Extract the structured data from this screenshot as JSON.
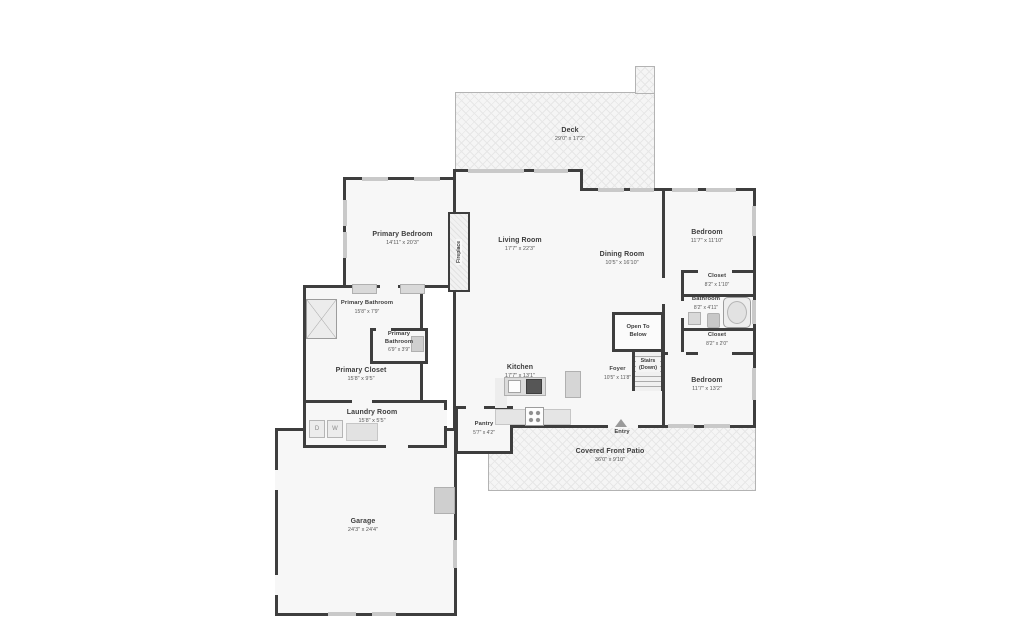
{
  "colors": {
    "wall": "#3e3e3e",
    "floor": "#f7f7f7",
    "window": "#c9c9c9",
    "hatch": "#e7e7e7",
    "text": "#3d3d3d"
  },
  "rooms": {
    "deck": {
      "name": "Deck",
      "dims": "29'0\" x 17'2\""
    },
    "primary_bedroom": {
      "name": "Primary Bedroom",
      "dims": "14'11\" x 20'3\""
    },
    "living_room": {
      "name": "Living Room",
      "dims": "17'7\" x 22'3\""
    },
    "dining_room": {
      "name": "Dining Room",
      "dims": "10'5\" x 16'10\""
    },
    "bedroom_upper": {
      "name": "Bedroom",
      "dims": "11'7\" x 11'10\""
    },
    "closet_upper": {
      "name": "Closet",
      "dims": "8'2\" x 1'10\""
    },
    "bathroom": {
      "name": "Bathroom",
      "dims": "8'2\" x 4'11\""
    },
    "closet_lower": {
      "name": "Closet",
      "dims": "8'2\" x 2'0\""
    },
    "bedroom_lower": {
      "name": "Bedroom",
      "dims": "11'7\" x 13'2\""
    },
    "foyer": {
      "name": "Foyer",
      "dims": "10'5\" x 11'8\""
    },
    "kitchen": {
      "name": "Kitchen",
      "dims": "17'7\" x 13'1\""
    },
    "pantry": {
      "name": "Pantry",
      "dims": "5'7\" x 4'2\""
    },
    "primary_bathroom": {
      "name": "Primary Bathroom",
      "dims": "15'8\" x 7'9\""
    },
    "primary_bathroom_2": {
      "name": "Primary Bathroom",
      "dims": "6'9\" x 3'9\""
    },
    "primary_closet": {
      "name": "Primary Closet",
      "dims": "15'8\" x 9'5\""
    },
    "laundry_room": {
      "name": "Laundry Room",
      "dims": "15'8\" x 5'5\""
    },
    "garage": {
      "name": "Garage",
      "dims": "24'3\" x 24'4\""
    },
    "covered_front_patio": {
      "name": "Covered Front Patio",
      "dims": "36'0\" x 9'10\""
    }
  },
  "annotations": {
    "fireplace": "Fireplace",
    "entry": "Entry",
    "open_to_below": {
      "line1": "Open To",
      "line2": "Below"
    },
    "stairs": {
      "line1": "Stairs",
      "line2": "(Down)"
    },
    "washer": "W",
    "dryer": "D"
  }
}
